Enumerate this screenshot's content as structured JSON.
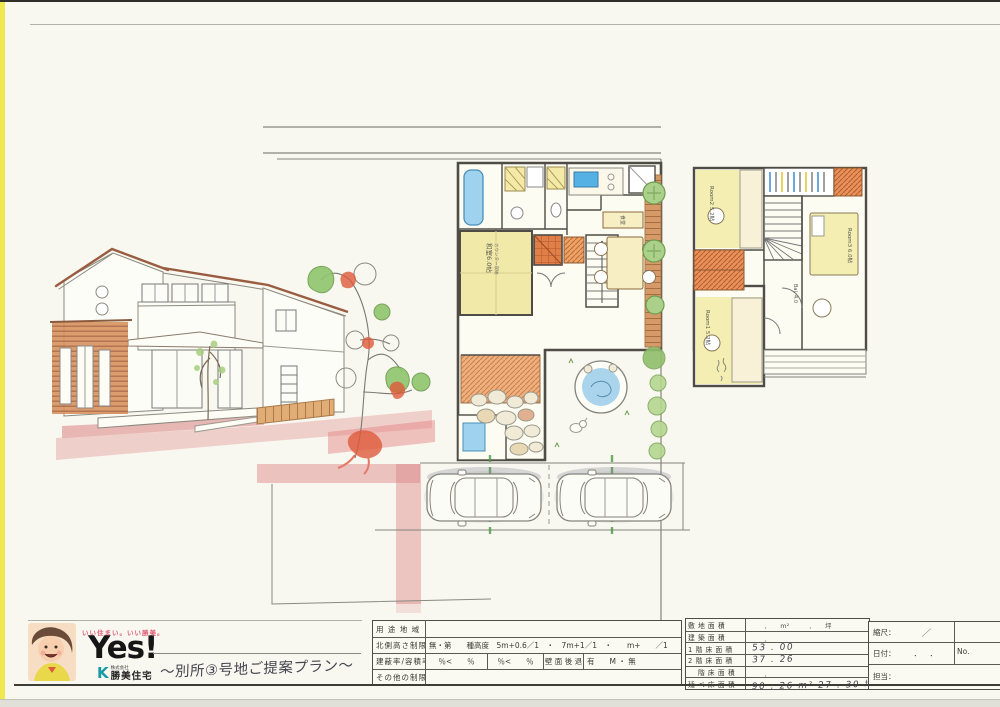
{
  "branding": {
    "tagline": "いい住まい。いい勝美。",
    "logo": "Yes!",
    "company_mark": "K",
    "company_prefix": "株式会社",
    "company_name": "勝美住宅",
    "plan_title": "〜別所③号地ご提案プラン〜",
    "tagline_color": "#e0607a",
    "mark_color": "#189aa6"
  },
  "regulation_table": {
    "row1_label": "用 途 地 域",
    "row1_value": "",
    "row2_label": "北側高さ制限",
    "row2_value": "無・第　　種高度　5m+0.6／1　・　7m+1／1　・　　m+　　／1",
    "row3_label": "建蔽率/容積率",
    "row3_c1": "％<　　％",
    "row3_c2": "％<　　％",
    "row3_c3": "壁 面 後 退",
    "row3_c4": "有　　M ・ 無",
    "row4_label": "その他の制限",
    "row4_value": ""
  },
  "area_table": {
    "r1_label": "敷 地 面 積",
    "r1_printed": "．　　m²　　　．　　坪",
    "r2_label": "建 築 面 積",
    "r2_printed": "．",
    "r3_label": "1 階 床 面 積",
    "r3_printed": "",
    "r3_value": "53 . 00",
    "r4_label": "2 階 床 面 積",
    "r4_printed": "",
    "r4_value": "37 . 26",
    "r5_label": "　 階 床 面 積",
    "r5_printed": "．",
    "r6_label": "延 べ 床 面 積",
    "r6_value": "90 . 26 m²  27 . 30 坪"
  },
  "meta": {
    "scale_label": "縮尺：",
    "scale_value": "／",
    "date_label": "日付：",
    "date_dots": "．．",
    "no_label": "No.",
    "staff_label": "担当："
  },
  "plan_1f": {
    "washitsu": "和室6.0帖",
    "washitsu_sub": "カウンター収納",
    "dining": "食堂"
  },
  "plan_2f": {
    "room1": "Room1 5.2帖",
    "room2": "Room2 5.2帖",
    "room3": "Room3 6.0帖",
    "balcony": "Bal. 4.0"
  }
}
